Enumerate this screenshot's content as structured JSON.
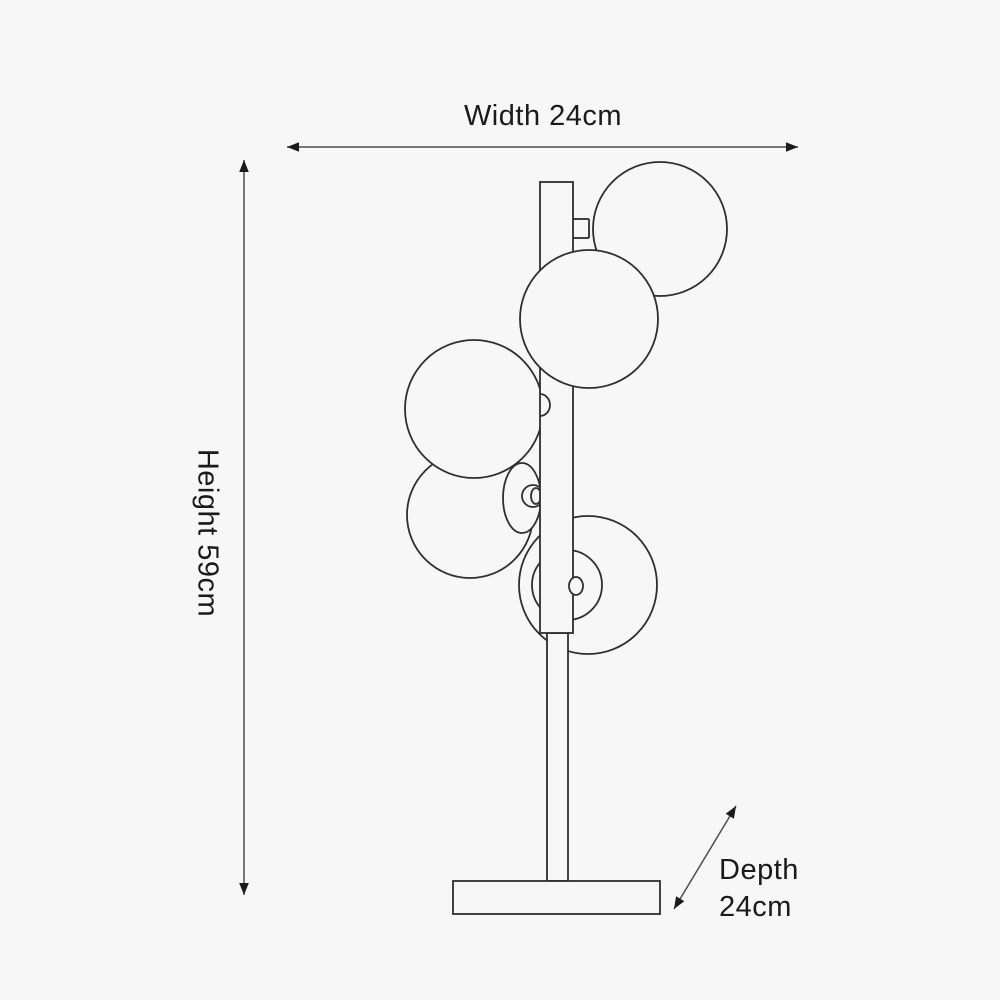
{
  "page": {
    "type": "Product dimension diagram",
    "subject": "Five-globe table lamp line drawing with dimension arrows",
    "background_color": "#f7f7f7",
    "line_color": "#2e2e2e",
    "dimension_line_color": "#4d4d4d",
    "text_color": "#1a1a1a"
  },
  "dimensions": {
    "width_label": "Width 24cm",
    "height_label": "Height 59cm",
    "depth_label_line1": "Depth",
    "depth_label_line2": "24cm"
  }
}
